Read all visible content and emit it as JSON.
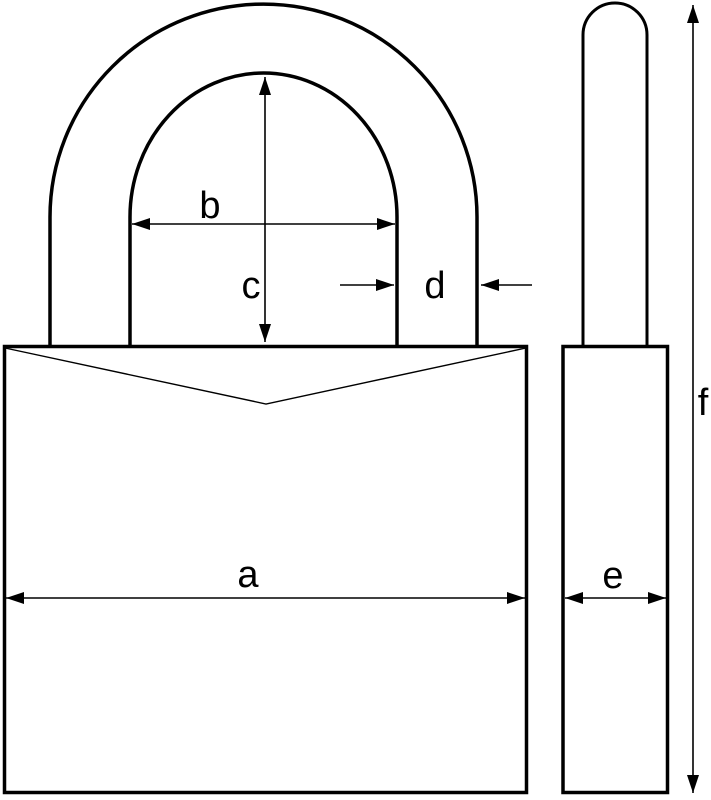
{
  "diagram": {
    "description": "Padlock dimension drawing: front view (body with V-notch top and U-shackle) and side view (narrow body with shackle rod), with dimension arrows a-f",
    "labels": {
      "a": "a",
      "b": "b",
      "c": "c",
      "d": "d",
      "e": "e",
      "f": "f"
    },
    "colors": {
      "line": "#000000",
      "background": "#ffffff"
    }
  }
}
